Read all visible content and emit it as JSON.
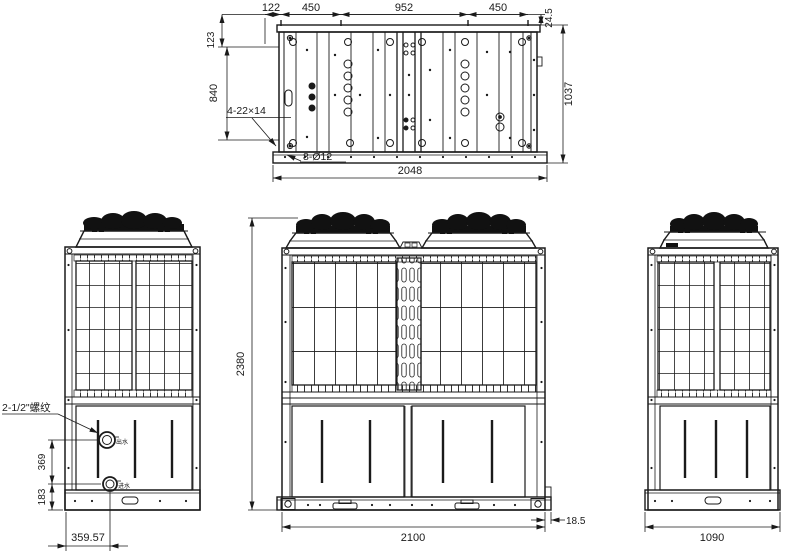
{
  "drawing": {
    "colors": {
      "ink": "#1a1a1a",
      "paper": "#ffffff"
    },
    "top_view": {
      "width_segments": [
        "122",
        "450",
        "952",
        "450"
      ],
      "rail_offset": "24.5",
      "left_inset": "123",
      "inner_height": "840",
      "overall_depth": "1037",
      "overall_length": "2048",
      "slot_callout": "4-22×14",
      "hole_callout": "8-Ø12"
    },
    "left_view": {
      "pipe_callout": "2-1/2\"螺纹",
      "outlet_label": "出水",
      "inlet_label": "进水",
      "pipe_spacing": "369",
      "pipe_base_offset": "183",
      "pipe_side_offset": "359.57"
    },
    "front_view": {
      "overall_height": "2380",
      "overall_width": "2100",
      "base_offset": "18.5"
    },
    "side_view": {
      "overall_width": "1090"
    }
  }
}
